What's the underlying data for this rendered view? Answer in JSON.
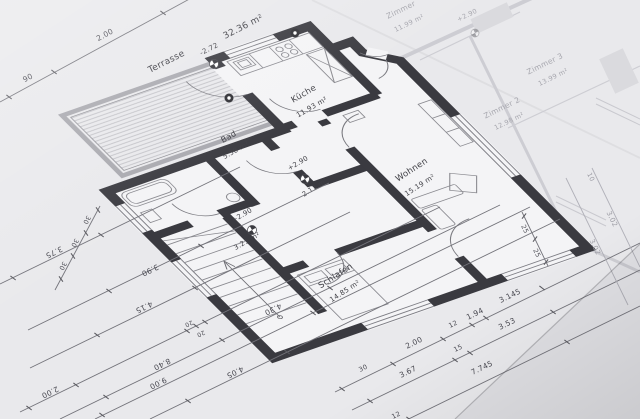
{
  "title": "floor-plan-blueprint-photo",
  "plan": {
    "terrasse": {
      "name": "Terrasse",
      "area": "32.36 m²",
      "level": "-2.72"
    },
    "kueche": {
      "name": "Küche",
      "area": "11.93 m²"
    },
    "bad": {
      "name": "Bad",
      "area": "5.58 m²"
    },
    "flur": {
      "area": "3.21 m²",
      "level": "+2.90"
    },
    "diele": {
      "area": "2.17 m²",
      "level": "+2.90"
    },
    "wohnen": {
      "name": "Wohnen",
      "area": "15.19 m²"
    },
    "schlafen": {
      "name": "Schlafen",
      "area": "14.85 m²"
    }
  },
  "underlay": {
    "zimmer1": {
      "name": "Zimmer",
      "area": "11.99 m²",
      "level": "+2.90"
    },
    "zimmer2": {
      "name": "Zimmer 2",
      "area": "12.98 m²"
    },
    "zimmer3": {
      "name": "Zimmer 3",
      "area": "13.99 m²"
    }
  },
  "dims": {
    "top_left": [
      "90",
      "2.00"
    ],
    "left": [
      "30",
      "30",
      "30",
      "3.75",
      "3.90",
      "4.15",
      "2.00",
      "20",
      "20",
      "8.40",
      "4.30",
      "9.00",
      "4.05"
    ],
    "right_inner": [
      "30",
      "2.00",
      "12",
      "1.94",
      "3.145"
    ],
    "right_mid": [
      "3.67",
      "15",
      "3.53"
    ],
    "right_outer": [
      "12",
      "7.745"
    ],
    "side": [
      "25",
      "25"
    ],
    "faint": [
      "10",
      "3.02",
      "3.02"
    ]
  },
  "colors": {
    "paper": "#e9e9ec",
    "wall": "#3a3a40",
    "thin_line": "#73737a",
    "hatch": "#c0c0c5",
    "faint_sheet": "#c9c9cf"
  }
}
